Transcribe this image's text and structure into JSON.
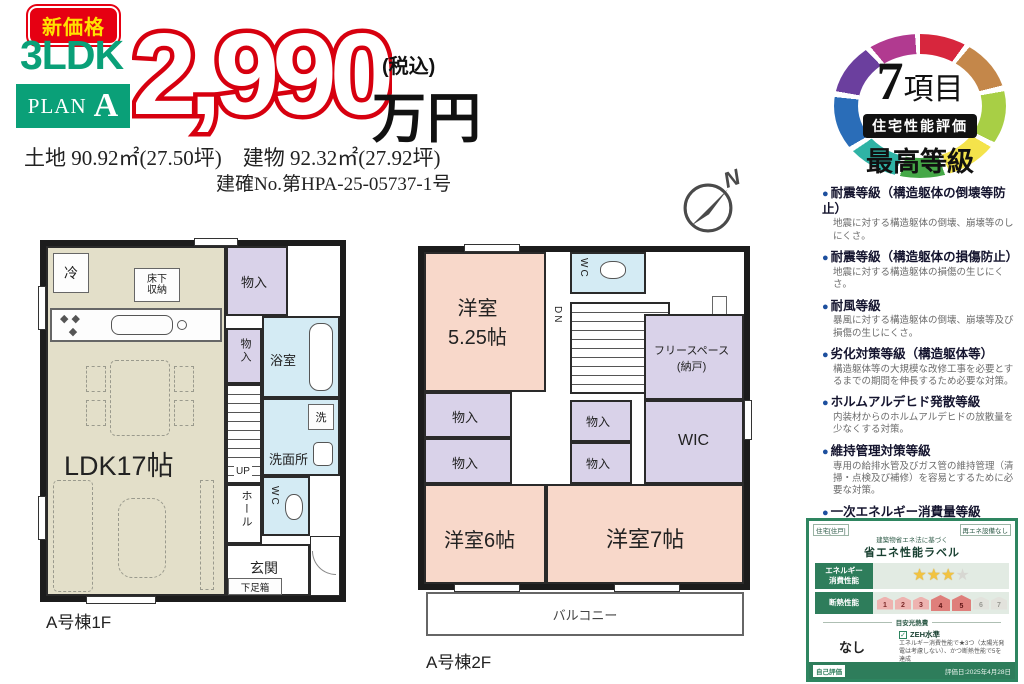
{
  "header": {
    "badge_new_price": "新価格",
    "ldk": "3LDK",
    "plan_word": "PLAN",
    "plan_letter": "A",
    "price": "2,990",
    "price_unit": "万円",
    "tax_note": "(税込)",
    "land_info": "土地 90.92㎡(27.50坪)　建物 92.32㎡(27.92坪)",
    "confirmation_no": "建確No.第HPA-25-05737-1号"
  },
  "compass": {
    "label": "N"
  },
  "floor1": {
    "caption": "A号棟1F",
    "labels": {
      "ldk": "LDK17帖",
      "fridge": "冷",
      "underfloor_1": "床下",
      "underfloor_2": "収納",
      "closet": "物入",
      "bath": "浴室",
      "wash_machine": "洗",
      "washroom": "洗面所",
      "stairs": "UP",
      "hall": "ホール",
      "wc": "WC",
      "entrance": "玄関",
      "shoe_box": "下足箱"
    }
  },
  "floor2": {
    "caption": "A号棟2F",
    "labels": {
      "room_525_1": "洋室",
      "room_525_2": "5.25帖",
      "wc": "WC",
      "stairs": "DN",
      "shelf": "棚",
      "free_space_1": "フリースペース",
      "free_space_2": "(納戸)",
      "closet": "物入",
      "wic": "WIC",
      "room_6": "洋室6帖",
      "room_7": "洋室7帖",
      "balcony": "バルコニー"
    }
  },
  "performance": {
    "badge": {
      "count_number": "7",
      "count_suffix": "項目",
      "label": "住宅性能評価",
      "grade": "最高等級"
    },
    "items": [
      {
        "title": "耐震等級（構造躯体の倒壊等防止）",
        "desc": "地震に対する構造躯体の倒壊、崩壊等のしにくさ。"
      },
      {
        "title": "耐震等級（構造躯体の損傷防止）",
        "desc": "地震に対する構造躯体の損傷の生じにくさ。"
      },
      {
        "title": "耐風等級",
        "desc": "暴風に対する構造躯体の倒壊、崩壊等及び損傷の生じにくさ。"
      },
      {
        "title": "劣化対策等級（構造躯体等）",
        "desc": "構造躯体等の大規模な改修工事を必要とするまでの期間を伸長するため必要な対策。"
      },
      {
        "title": "ホルムアルデヒド発散等級",
        "desc": "内装材からのホルムアルデヒドの放散量を少なくする対策。"
      },
      {
        "title": "維持管理対策等級",
        "desc": "専用の給排水管及びガス管の維持管理（清掃・点検及び補修）を容易とするために必要な対策。"
      },
      {
        "title": "一次エネルギー消費量等級",
        "desc": "一次エネルギー消費量の削減のための対策。"
      }
    ]
  },
  "energy_label": {
    "type_label": "住宅[住戸]",
    "renewable": "再エネ設備なし",
    "subtitle": "建築物省エネ法に基づく",
    "title": "省エネ性能ラベル",
    "row1_label_1": "エネルギー",
    "row1_label_2": "消費性能",
    "row2_label": "断熱性能",
    "stars": [
      "filled",
      "filled",
      "filled",
      "empty"
    ],
    "insulation": [
      {
        "n": "1",
        "state": "pink"
      },
      {
        "n": "2",
        "state": "pink"
      },
      {
        "n": "3",
        "state": "pink"
      },
      {
        "n": "4",
        "state": "red"
      },
      {
        "n": "5",
        "state": "red"
      },
      {
        "n": "6",
        "state": "gray"
      },
      {
        "n": "7",
        "state": "gray"
      }
    ],
    "estimate_label": "目安光熱費",
    "estimate_value": "なし",
    "zeh_check": "✓",
    "zeh_label": "ZEH水準",
    "zeh_note": "エネルギー消費性能で★3つ（太陽光発電は考慮しない）、かつ断熱性能で5を達成",
    "self_eval": "自己評価",
    "eval_date": "評価日:2025年4月28日"
  },
  "colors": {
    "brand_green": "#0aa078",
    "price_red": "#d7000f",
    "badge_red": "#e60012",
    "badge_yellow": "#ffe100",
    "ldk_beige": "#e3dfc9",
    "room_pink": "#f8d8ca",
    "closet_purple": "#d9d2e9",
    "wet_blue": "#d4ebf4",
    "wall_black": "#1c1c1c",
    "bullet_blue": "#1d4f9e",
    "label_green": "#2e7d5b",
    "star_gold": "#f2c341"
  }
}
